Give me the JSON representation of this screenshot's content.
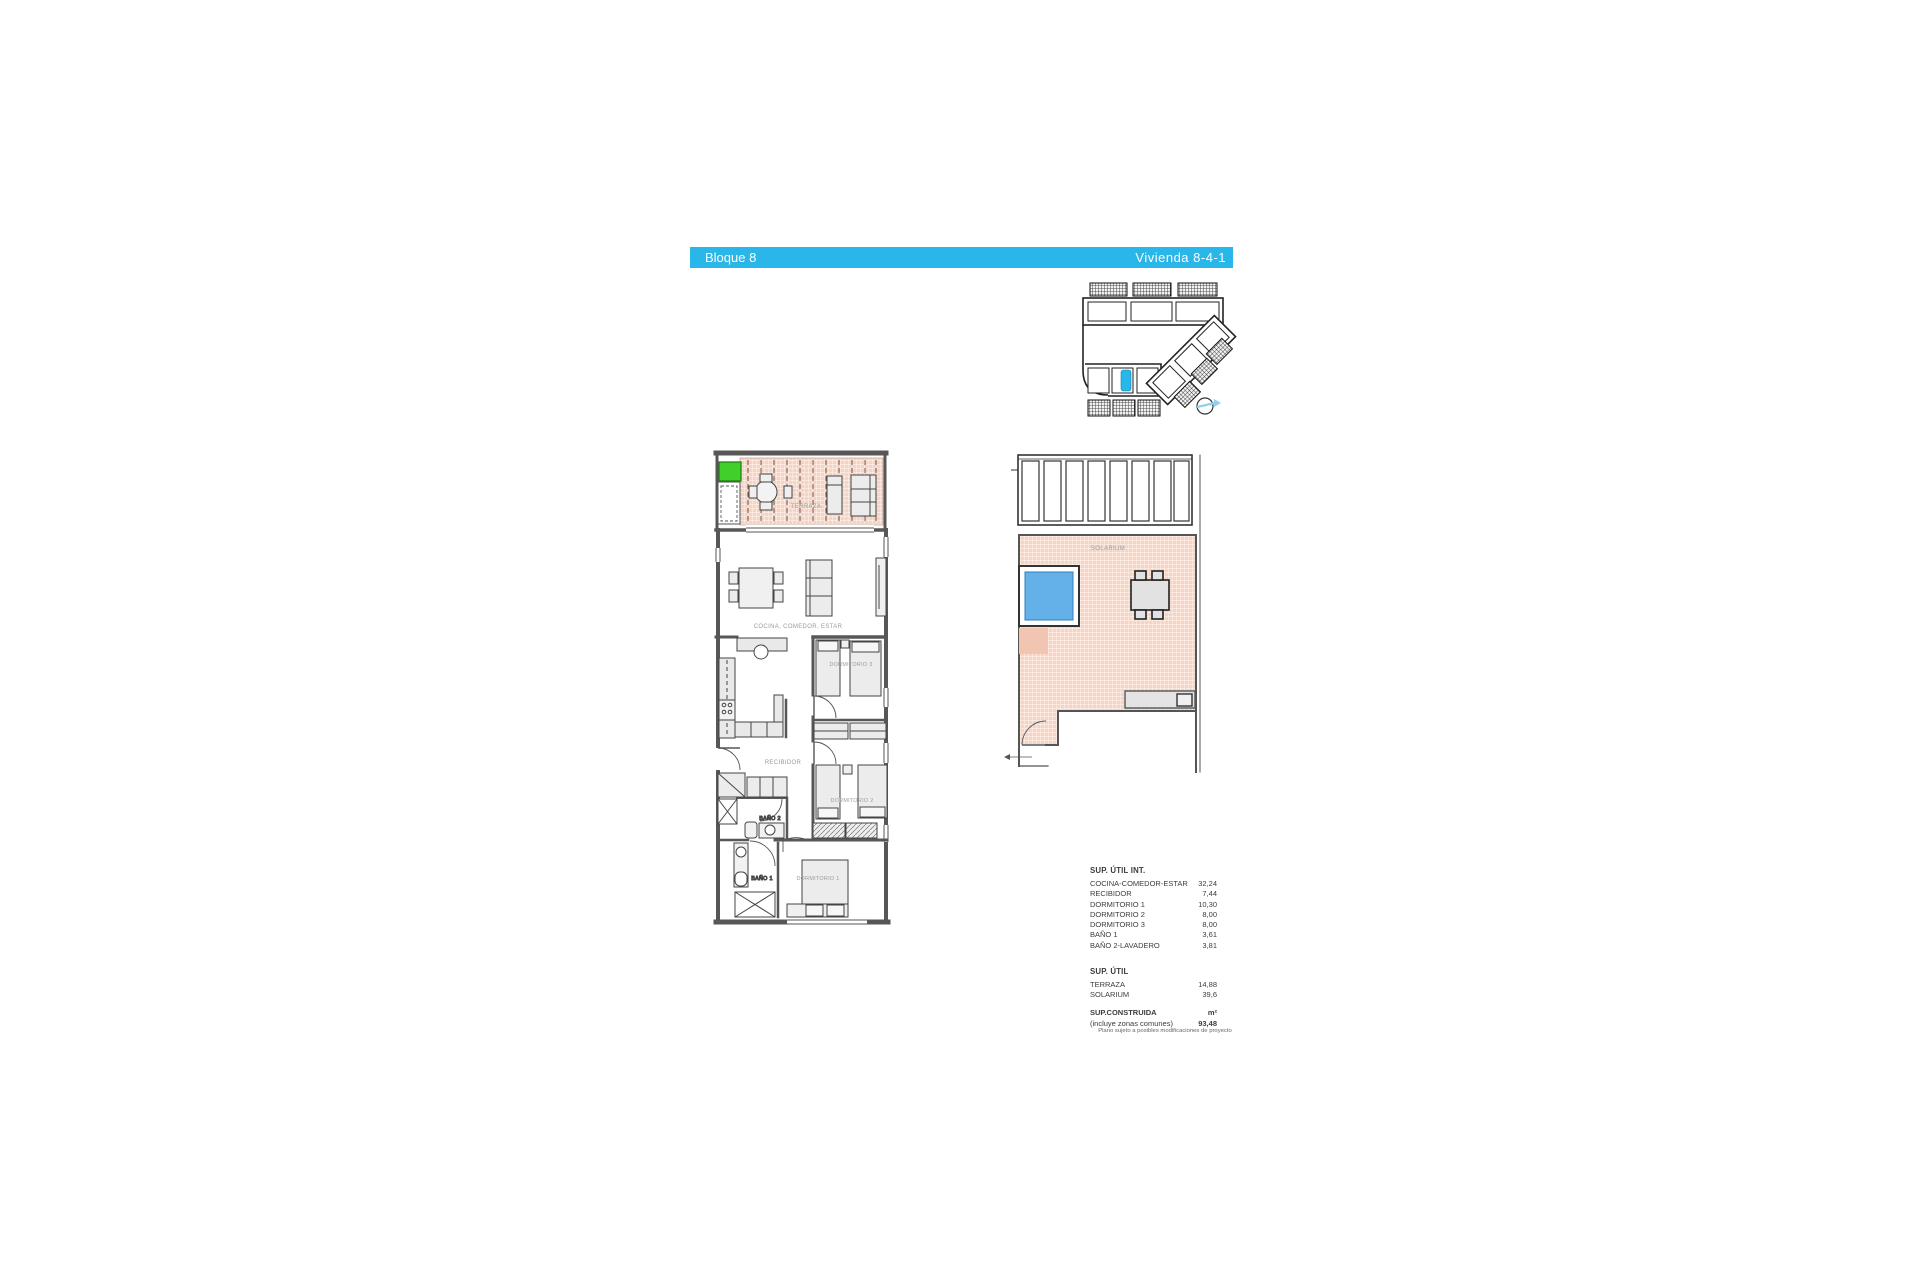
{
  "header": {
    "left": "Bloque 8",
    "right": "Vivienda 8-4-1"
  },
  "rooms": {
    "terraza": "TERRAZA",
    "cocina": "COCINA, COMEDOR, ESTAR",
    "dormitorio3": "DORMITORIO 3",
    "recibidor": "RECIBIDOR",
    "bano2": "BAÑO 2",
    "dormitorio2": "DORMITORIO 2",
    "bano1": "BAÑO 1",
    "dormitorio1": "DORMITORIO 1",
    "solarium": "SOLARIUM"
  },
  "areas": {
    "int": {
      "title": "SUP. ÚTIL INT.",
      "rows": [
        {
          "label": "COCINA-COMEDOR-ESTAR",
          "value": "32,24"
        },
        {
          "label": "RECIBIDOR",
          "value": "7,44"
        },
        {
          "label": "DORMITORIO 1",
          "value": "10,30"
        },
        {
          "label": "DORMITORIO 2",
          "value": "8,00"
        },
        {
          "label": "DORMITORIO 3",
          "value": "8,00"
        },
        {
          "label": "BAÑO 1",
          "value": "3,61"
        },
        {
          "label": "BAÑO 2-LAVADERO",
          "value": "3,81"
        }
      ]
    },
    "ext": {
      "title": "SUP. ÚTIL",
      "rows": [
        {
          "label": "TERRAZA",
          "value": "14,88"
        },
        {
          "label": "SOLARIUM",
          "value": "39,6"
        }
      ]
    },
    "construida": {
      "label": "SUP.CONSTRUIDA",
      "sublabel": "(incluye zonas comunes)",
      "unit": "m²",
      "value": "93,48"
    }
  },
  "footer_note": "Plano sujeto a posibles modificaciones de proyecto",
  "colors": {
    "accent": "#29b6e8",
    "terrace_fill": "#f6d4c4",
    "pool_blue": "#64b1ea",
    "highlight_green": "#3fd02a",
    "wall_gray": "#575757"
  }
}
